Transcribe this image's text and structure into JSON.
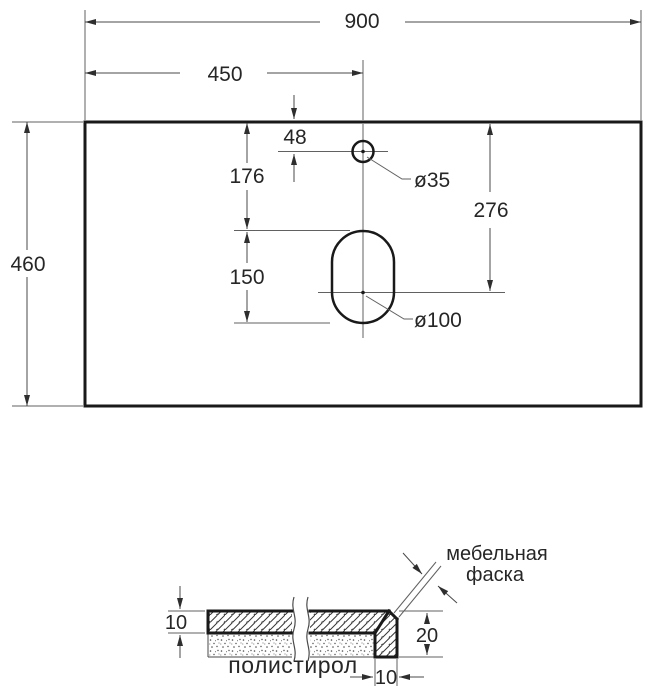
{
  "drawing": {
    "kind": "countertop dimensional drawing",
    "top_view": {
      "overall_width": "900",
      "faucet_center_from_left": "450",
      "overall_depth": "460",
      "faucet_offset_from_back": "48",
      "faucet_hole_diameter": "ø35",
      "drain_slot_offset_from_back": "176",
      "drain_slot_length": "150",
      "drain_center_from_back": "276",
      "drain_hole_diameter": "ø100"
    },
    "section_view": {
      "top_thickness": "10",
      "edge_height": "20",
      "edge_width": "10",
      "chamfer_label": [
        "мебельная",
        "фаска"
      ],
      "filler_label": "полистирол"
    },
    "colors": {
      "outline": "#191919",
      "thin_line": "#616161",
      "text": "#262626",
      "background": "#ffffff"
    }
  }
}
